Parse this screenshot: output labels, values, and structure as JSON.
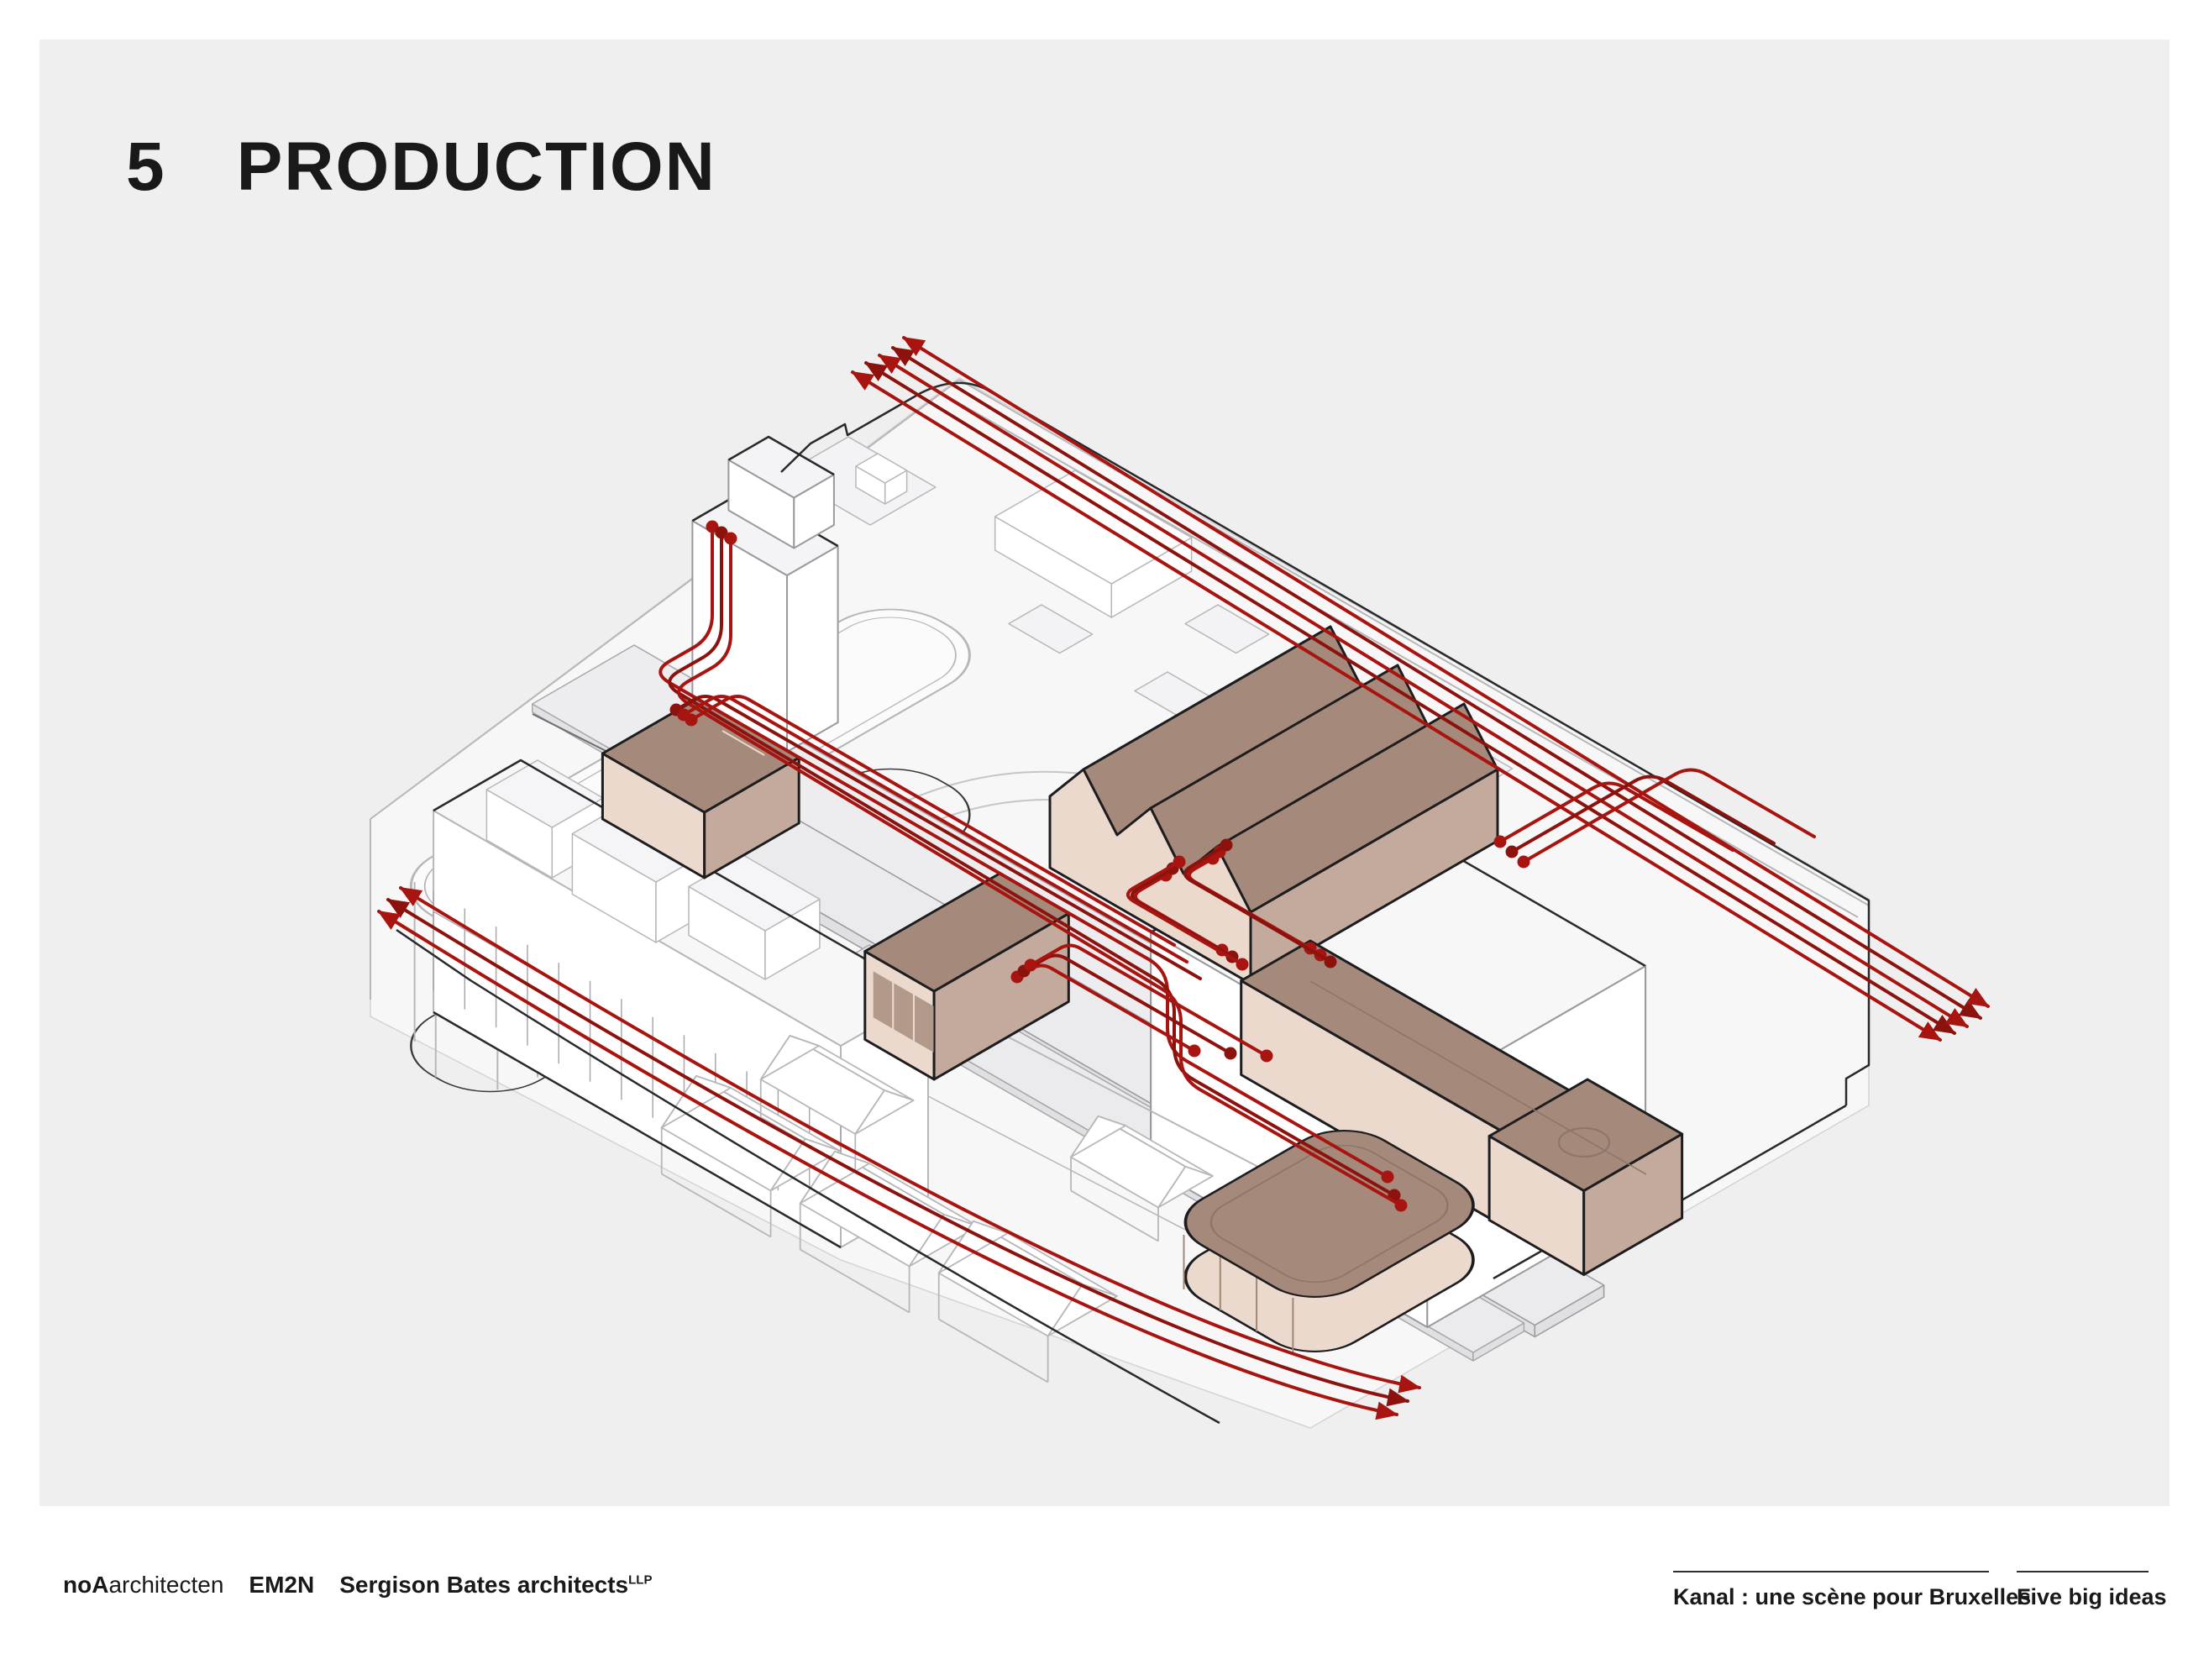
{
  "page": {
    "background": "#ffffff",
    "panel_background": "#efeff0"
  },
  "header": {
    "number": "5",
    "title": "PRODUCTION",
    "text_color": "#191919"
  },
  "footer": {
    "text_color": "#191919",
    "rule_color": "#2f2f31",
    "credits": [
      {
        "bold": "noA",
        "rest": "architecten",
        "sup": ""
      },
      {
        "bold": "EM2N",
        "rest": "",
        "sup": ""
      },
      {
        "bold": "Sergison Bates architects",
        "rest": "",
        "sup": "LLP"
      }
    ],
    "right": [
      {
        "label": "Kanal : une scène pour Bruxelles"
      },
      {
        "label": "Five big ideas"
      }
    ]
  },
  "diagram": {
    "colors": {
      "flow_red": "#a81410",
      "flow_red_dark": "#8c120e",
      "volume_top": "#a5897b",
      "volume_side": "#c3aa9c",
      "volume_light": "#ead9cc",
      "volume_accent": "#8b7668",
      "wireframe": "#b7b7ba",
      "wireframe_mid": "#9a9a9e",
      "wireframe_dark": "#29292b",
      "mass_fill": "#f7f7f8",
      "slab_fill": "#ededf0"
    },
    "marks": {
      "flow_line": "production-flow-route",
      "flow_arrow": "flow-direction-arrow",
      "flow_origin_dot": "flow-origin-point",
      "brown_volume": "production-space"
    }
  }
}
